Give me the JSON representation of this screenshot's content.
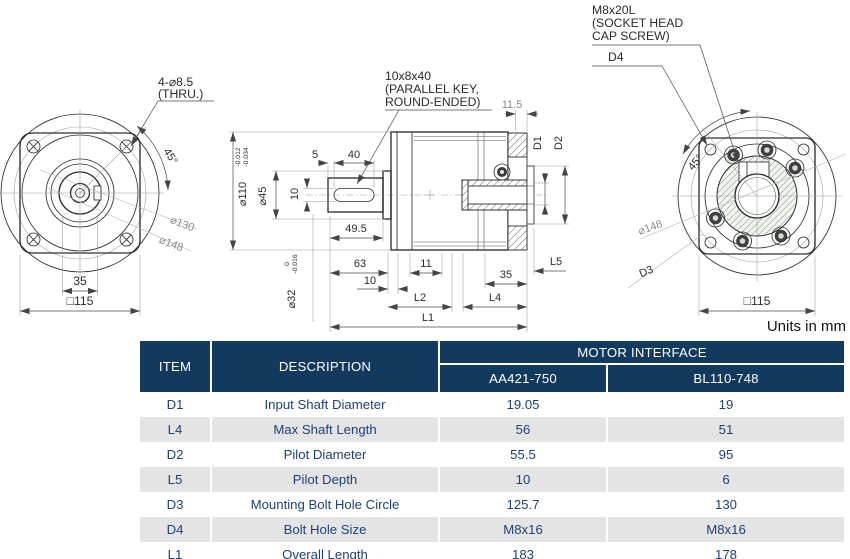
{
  "drawing": {
    "units_label": "Units in mm",
    "front_view": {
      "note_line1": "4-⌀8.5",
      "note_line2": "(THRU.)",
      "angle_label": "45°",
      "dia130_label": "⌀130",
      "dia148_label": "⌀148",
      "dim_35": "35",
      "dim_square115": "□115"
    },
    "section_view": {
      "key_note_line1": "10x8x40",
      "key_note_line2": "(PARALLEL KEY,",
      "key_note_line3": "ROUND-ENDED)",
      "dim_5": "5",
      "dim_40": "40",
      "dim_key_width": "10",
      "dia45_label": "⌀45",
      "dia110_label": "⌀110",
      "dia110_tol_upper": "-0.012",
      "dia110_tol_lower": "-0.034",
      "dia32_label": "⌀32",
      "dia32_tol_upper": "0",
      "dia32_tol_lower": "-0.016",
      "dim_49_5": "49.5",
      "dim_63": "63",
      "dim_10": "10",
      "dim_11": "11",
      "dim_11_5": "11.5",
      "dim_35": "35",
      "dim_L1": "L1",
      "dim_L2": "L2",
      "dim_L4": "L4",
      "dim_L5": "L5",
      "dim_D1": "D1",
      "dim_D2": "D2"
    },
    "rear_view": {
      "screw_note_line1": "M8x20L",
      "screw_note_line2": "(SOCKET HEAD",
      "screw_note_line3": "CAP SCREW)",
      "dim_D4": "D4",
      "dim_D3": "D3",
      "angle_label": "45°",
      "dia148_label": "⌀148",
      "dim_square115": "□115"
    }
  },
  "table": {
    "header": {
      "item": "ITEM",
      "description": "DESCRIPTION",
      "motor_interface": "MOTOR INTERFACE",
      "col1": "AA421-750",
      "col2": "BL110-748"
    },
    "rows": [
      {
        "item": "D1",
        "description": "Input Shaft Diameter",
        "col1": "19.05",
        "col2": "19"
      },
      {
        "item": "L4",
        "description": "Max Shaft Length",
        "col1": "56",
        "col2": "51"
      },
      {
        "item": "D2",
        "description": "Pilot Diameter",
        "col1": "55.5",
        "col2": "95"
      },
      {
        "item": "L5",
        "description": "Pilot Depth",
        "col1": "10",
        "col2": "6"
      },
      {
        "item": "D3",
        "description": "Mounting Bolt Hole Circle",
        "col1": "125.7",
        "col2": "130"
      },
      {
        "item": "D4",
        "description": "Bolt Hole Size",
        "col1": "M8x16",
        "col2": "M8x16"
      },
      {
        "item": "L1",
        "description": "Overall Length",
        "col1": "183",
        "col2": "178"
      }
    ],
    "colors": {
      "header_bg": "#12395e",
      "header_text": "#ffffff",
      "row_alt_bg": "#e4e4e4",
      "row_text": "#1c4178"
    }
  }
}
